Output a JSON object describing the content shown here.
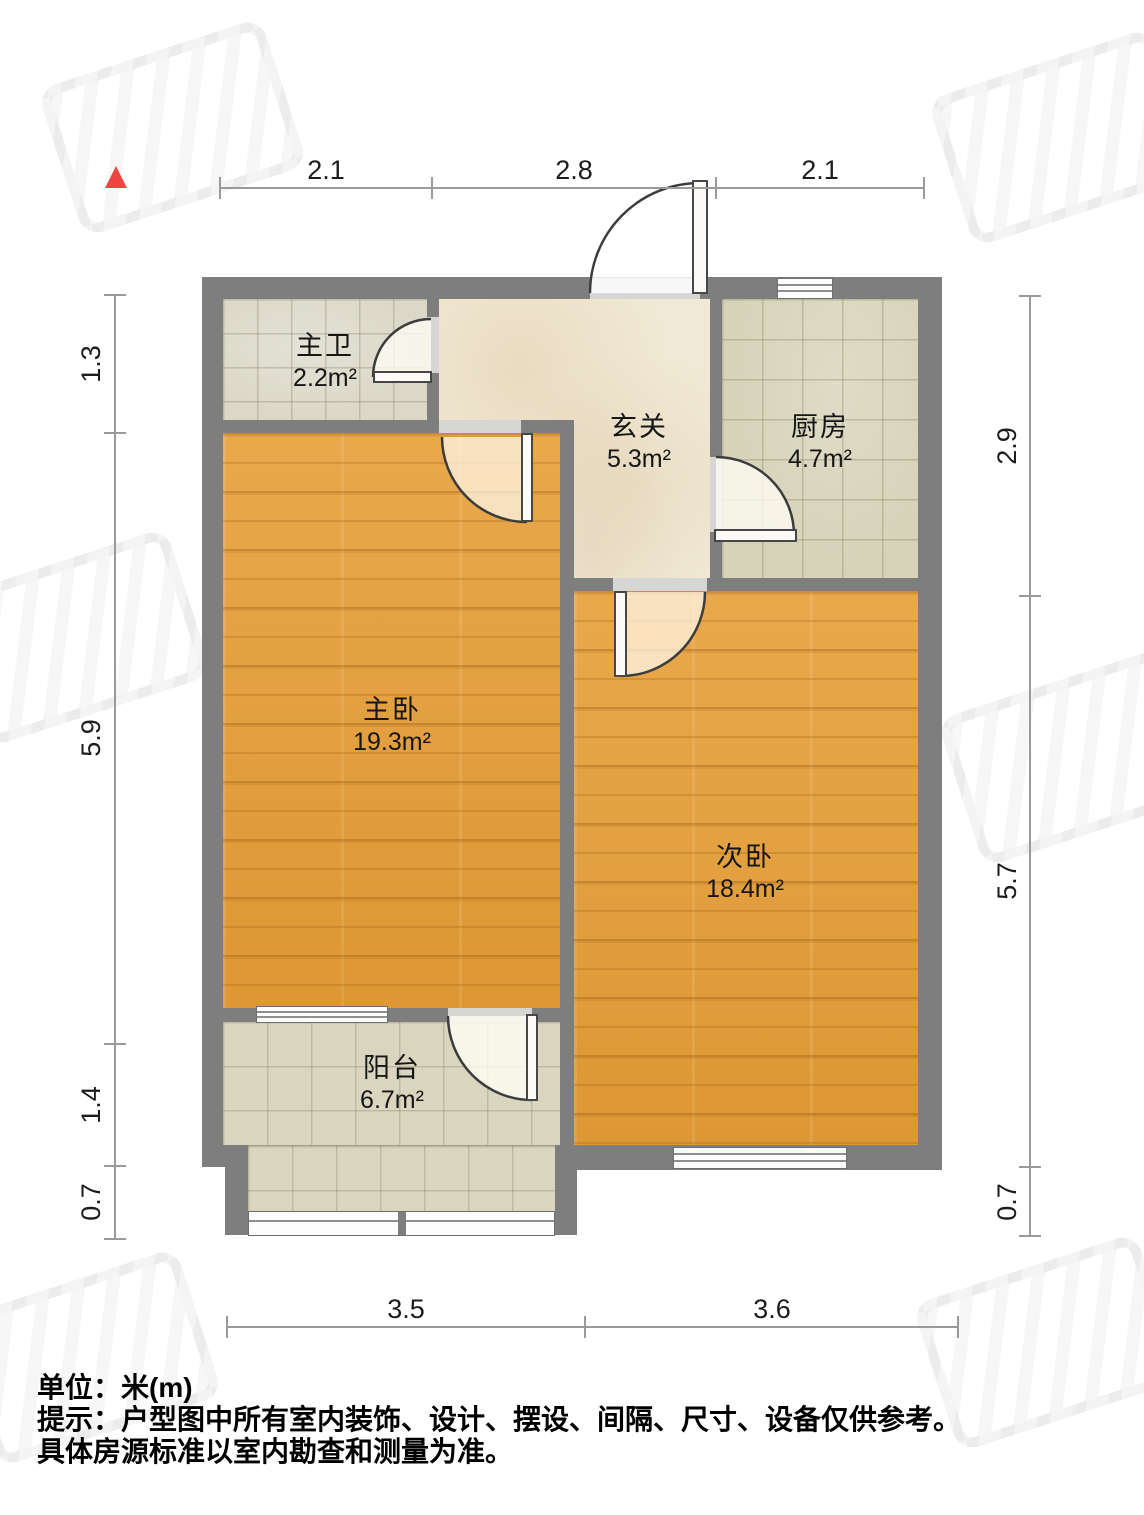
{
  "title": "户型图",
  "north_arrow": {
    "color": "#f0453f",
    "direction": "up"
  },
  "rooms": {
    "bathroom": {
      "name": "主卫",
      "area": "2.2m²"
    },
    "hall": {
      "name": "玄关",
      "area": "5.3m²"
    },
    "kitchen": {
      "name": "厨房",
      "area": "4.7m²"
    },
    "master": {
      "name": "主卧",
      "area": "19.3m²"
    },
    "second": {
      "name": "次卧",
      "area": "18.4m²"
    },
    "balcony": {
      "name": "阳台",
      "area": "6.7m²"
    }
  },
  "dimensions": {
    "top": [
      "2.1",
      "2.8",
      "2.1"
    ],
    "bottom": [
      "3.5",
      "3.6"
    ],
    "left": [
      "1.3",
      "5.9",
      "1.4",
      "0.7"
    ],
    "right": [
      "2.9",
      "5.7",
      "0.7"
    ]
  },
  "footer": {
    "unit_note": "单位：米(m)",
    "tip_line1": "提示：户型图中所有室内装饰、设计、摆设、间隔、尺寸、设备仅供参考。",
    "tip_line2": "具体房源标准以室内勘查和测量为准。"
  },
  "colors": {
    "wall": "#7e7e7e",
    "wood_floor": "#e19c3c",
    "tile_floor": "#d7d3b9",
    "marble_floor": "#f1e9d5",
    "dimension_line": "#9a9a9a"
  }
}
